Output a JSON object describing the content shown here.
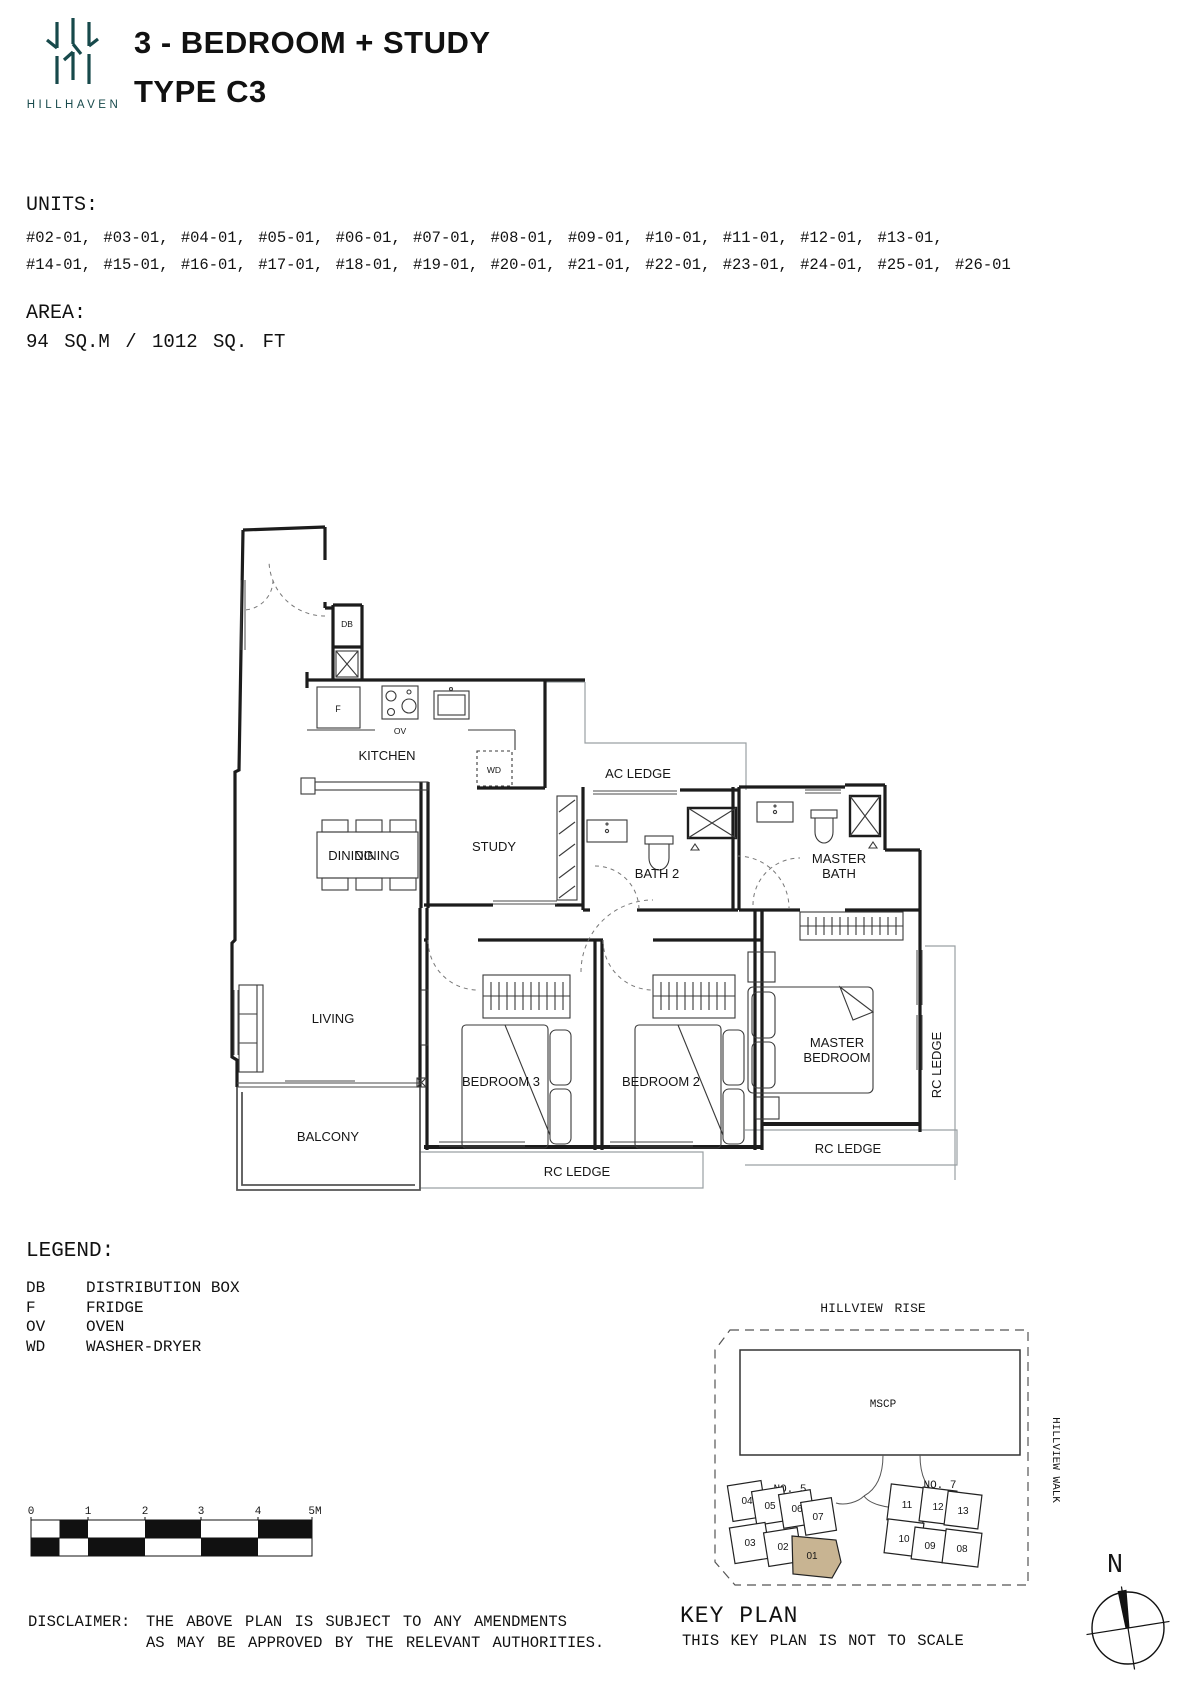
{
  "header": {
    "brand": "HILLHAVEN",
    "brand_color": "#17494b",
    "title_line1": "3 - BEDROOM + STUDY",
    "title_line2": "TYPE C3"
  },
  "units": {
    "label": "UNITS:",
    "line1": "#02-01, #03-01, #04-01, #05-01, #06-01, #07-01, #08-01, #09-01, #10-01, #11-01, #12-01, #13-01,",
    "line2": "#14-01, #15-01, #16-01, #17-01, #18-01, #19-01, #20-01, #21-01, #22-01, #23-01, #24-01, #25-01, #26-01"
  },
  "area": {
    "label": "AREA:",
    "value": "94 SQ.M / 1012 SQ. FT"
  },
  "floorplan": {
    "labels": {
      "kitchen": "KITCHEN",
      "dining": "DINING",
      "study": "STUDY",
      "bath2": "BATH 2",
      "master_bath": [
        "MASTER",
        "BATH"
      ],
      "living": "LIVING",
      "bedroom3": "BEDROOM 3",
      "bedroom2": "BEDROOM 2",
      "master_bedroom": [
        "MASTER",
        "BEDROOM"
      ],
      "balcony": "BALCONY",
      "ac_ledge": "AC LEDGE",
      "rc_ledge": "RC LEDGE",
      "db": "DB",
      "fridge": "F",
      "oven": "OV",
      "wd": "WD"
    }
  },
  "legend": {
    "label": "LEGEND:",
    "items": [
      {
        "abbr": "DB",
        "desc": "DISTRIBUTION BOX"
      },
      {
        "abbr": "F",
        "desc": "FRIDGE"
      },
      {
        "abbr": "OV",
        "desc": "OVEN"
      },
      {
        "abbr": "WD",
        "desc": "WASHER-DRYER"
      }
    ]
  },
  "scalebar": {
    "ticks": [
      "0",
      "1",
      "2",
      "3",
      "4",
      "5M"
    ]
  },
  "keyplan": {
    "title": "KEY PLAN",
    "subtitle": "THIS KEY PLAN IS NOT TO SCALE",
    "road_top": "HILLVIEW RISE",
    "road_right": "HILLVIEW WALK",
    "mscp": "MSCP",
    "no5": "NO. 5",
    "no7": "NO. 7",
    "blocks_no5_top": [
      "04",
      "05",
      "06",
      "07"
    ],
    "blocks_no5_bottom": [
      "03",
      "02",
      "01"
    ],
    "blocks_no7_top": [
      "11",
      "12",
      "13"
    ],
    "blocks_no7_bottom": [
      "10",
      "09",
      "08"
    ],
    "highlight_unit": "01",
    "highlight_color": "#c8b492"
  },
  "compass": {
    "north": "N"
  },
  "disclaimer": {
    "label": "DISCLAIMER:",
    "line1": "THE ABOVE PLAN IS SUBJECT TO ANY AMENDMENTS",
    "line2": "AS MAY BE APPROVED BY THE RELEVANT AUTHORITIES."
  }
}
